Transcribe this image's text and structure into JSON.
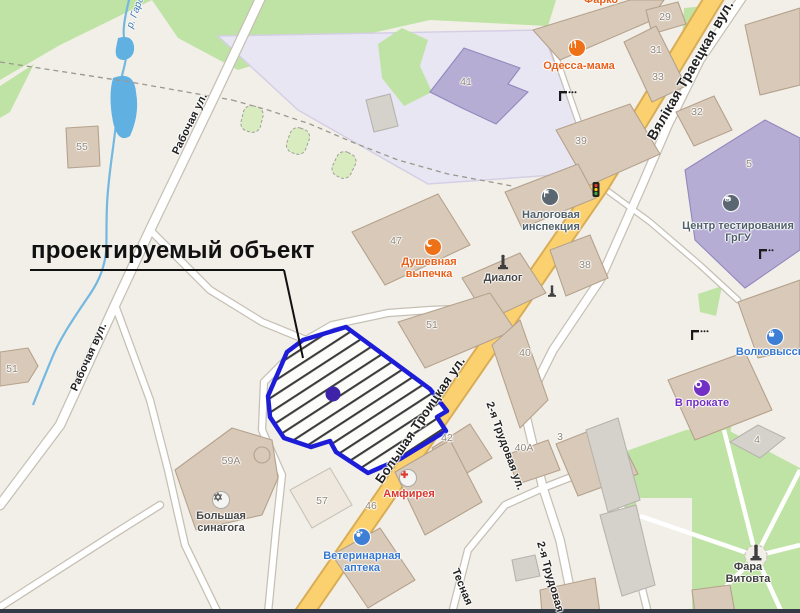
{
  "callout": {
    "label": "проектируемый объект"
  },
  "streets": [
    {
      "name": "Вялікая Траецкая вул."
    },
    {
      "name": "Большая Троицкая ул."
    },
    {
      "name": "Рабочая ул."
    },
    {
      "name": "Рабочая вул."
    },
    {
      "name": "2-я Трудовая ул."
    },
    {
      "name": "2-я Трудовая"
    },
    {
      "name": "Тесная"
    },
    {
      "name": "р. Гарадн."
    }
  ],
  "pois": [
    {
      "name": "Одесса-мама",
      "icon": "restaurant-icon",
      "color": "#e8611c"
    },
    {
      "name": "Фарко",
      "icon": "restaurant-icon",
      "color": "#e8611c"
    },
    {
      "name": "Душевная выпечка",
      "icon": "bakery-icon",
      "color": "#e8611c"
    },
    {
      "name": "Налоговая инспекция",
      "icon": "flag-icon",
      "color": "#50606b"
    },
    {
      "name": "Диалог",
      "icon": "memorial-icon",
      "color": "#474747"
    },
    {
      "name": "Центр тестирования ГрГУ",
      "icon": "education-icon",
      "color": "#50606b"
    },
    {
      "name": "Волковысские",
      "icon": "supermarket-icon",
      "color": "#3677cf"
    },
    {
      "name": "В прокате",
      "icon": "rental-icon",
      "color": "#7230c4"
    },
    {
      "name": "Амфирея",
      "icon": "pharmacy-cross-icon",
      "color": "#d9352c"
    },
    {
      "name": "Ветеринарная аптека",
      "icon": "paw-icon",
      "color": "#3677cf"
    },
    {
      "name": "Большая синагога",
      "icon": "star-of-david-icon",
      "color": "#4a4a4a"
    },
    {
      "name": "Фара Витовта",
      "icon": "monument-icon",
      "color": "#3f3f3f"
    }
  ],
  "house_numbers": [
    "55",
    "41",
    "29",
    "31",
    "33",
    "32",
    "39",
    "38",
    "5",
    "47",
    "51",
    "51",
    "40",
    "42",
    "40А",
    "3",
    "46",
    "57",
    "59А",
    "4"
  ],
  "project_area": {
    "label": "проектируемый объект",
    "outline_color": "#1d1dd8",
    "marker_color": "#3e22a8",
    "fill_pattern": "diagonal-hatch"
  },
  "colors": {
    "background": "#f2efe9",
    "main_road": "#fbd170",
    "green_area": "#bfe3a4",
    "school_grounds": "#e9e6f3",
    "building": "#d8c9b8",
    "water": "#60b1e2"
  }
}
